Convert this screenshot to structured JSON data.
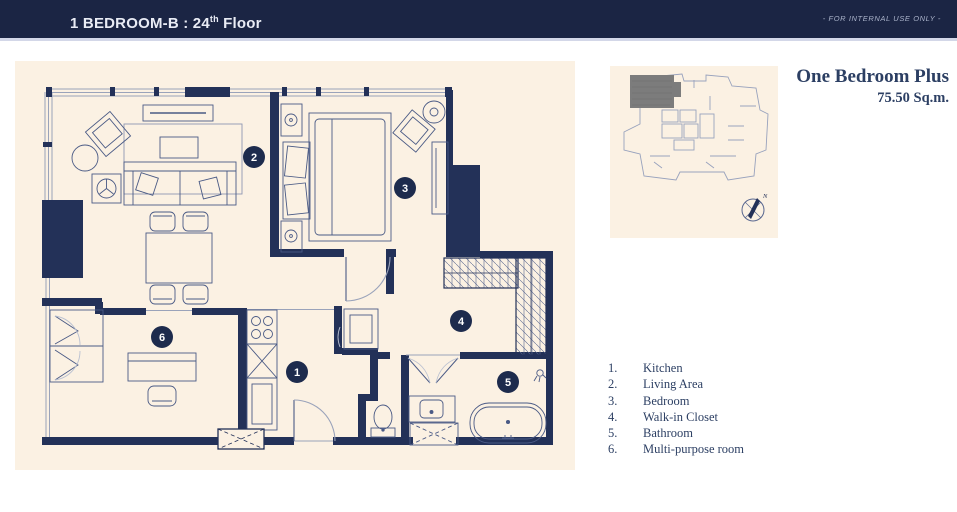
{
  "header": {
    "title_prefix": "1 BEDROOM-B : 24",
    "title_sup": "th",
    "title_suffix": " Floor",
    "note": "- FOR INTERNAL USE ONLY -"
  },
  "unit": {
    "name": "One Bedroom Plus",
    "area": "75.50 Sq.m."
  },
  "legend": {
    "items": [
      {
        "num": "1.",
        "label": "Kitchen"
      },
      {
        "num": "2.",
        "label": "Living Area"
      },
      {
        "num": "3.",
        "label": "Bedroom"
      },
      {
        "num": "4.",
        "label": "Walk-in Closet"
      },
      {
        "num": "5.",
        "label": "Bathroom"
      },
      {
        "num": "6.",
        "label": "Multi-purpose room"
      }
    ]
  },
  "plan": {
    "markers": [
      "1",
      "2",
      "3",
      "4",
      "5",
      "6"
    ]
  },
  "compass": {
    "label": "N"
  },
  "colors": {
    "header_bg": "#1b2544",
    "panel_cream": "#fbf1e3",
    "wall_navy": "#233158",
    "text_navy": "#2c3f63",
    "marker_bg": "#1d2b4d",
    "keyplan_unit_gray": "#7c7c7c"
  }
}
